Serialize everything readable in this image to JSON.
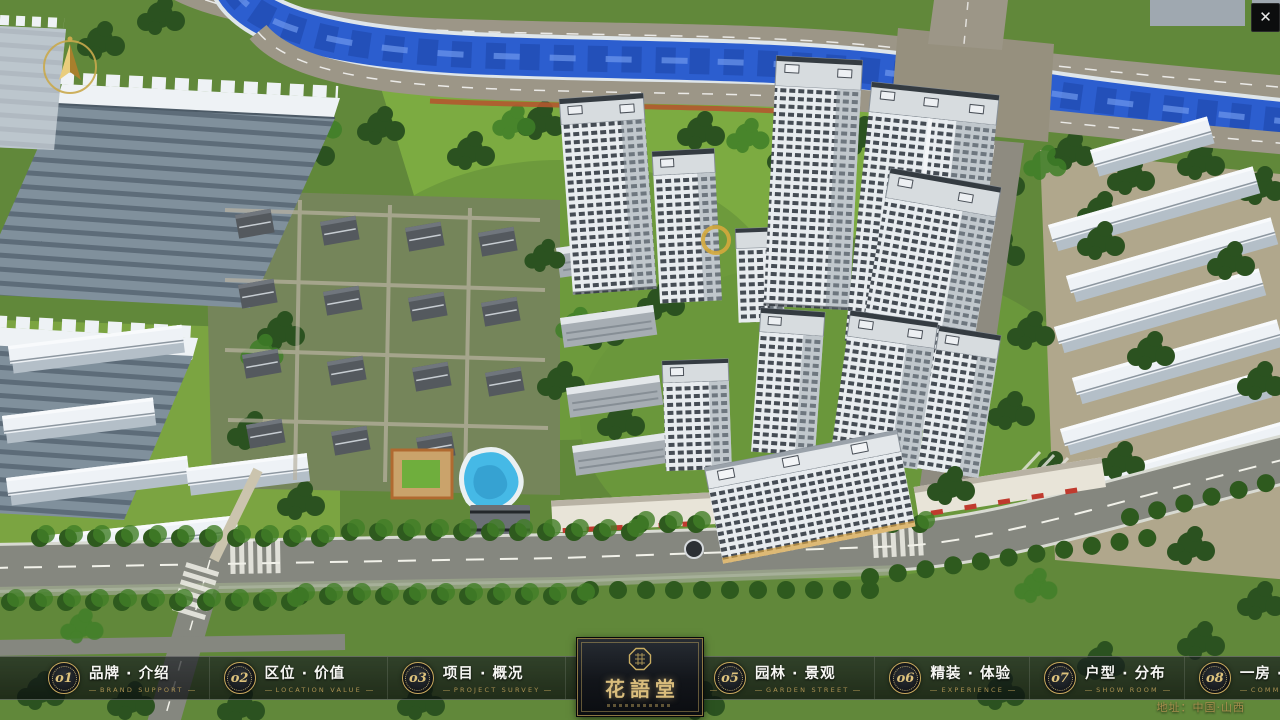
{
  "window": {
    "close_glyph": "✕"
  },
  "nav": {
    "items": [
      {
        "num": "o1",
        "zh": "品牌 · 介绍",
        "en": "BRAND SUPPORT"
      },
      {
        "num": "o2",
        "zh": "区位 · 价值",
        "en": "LOCATION VALUE"
      },
      {
        "num": "o3",
        "zh": "项目 · 概况",
        "en": "PROJECT SURVEY"
      },
      {
        "num": "o4",
        "zh": "建筑 · 鉴赏",
        "en": "APPRECIATION"
      },
      {
        "num": "o5",
        "zh": "园林 · 景观",
        "en": "GARDEN STREET"
      },
      {
        "num": "o6",
        "zh": "精装 · 体验",
        "en": "EXPERIENCE"
      },
      {
        "num": "o7",
        "zh": "户型 · 分布",
        "en": "SHOW ROOM"
      },
      {
        "num": "o8",
        "zh": "一房 · 一景",
        "en": "COMMUNITY"
      }
    ]
  },
  "logo": {
    "title": "花語堂"
  },
  "footer": {
    "address": "地址：中国·山西"
  },
  "colors": {
    "gold": "#c9ad62",
    "river": "#2c5ecf",
    "accent_red": "#c03a2e"
  }
}
